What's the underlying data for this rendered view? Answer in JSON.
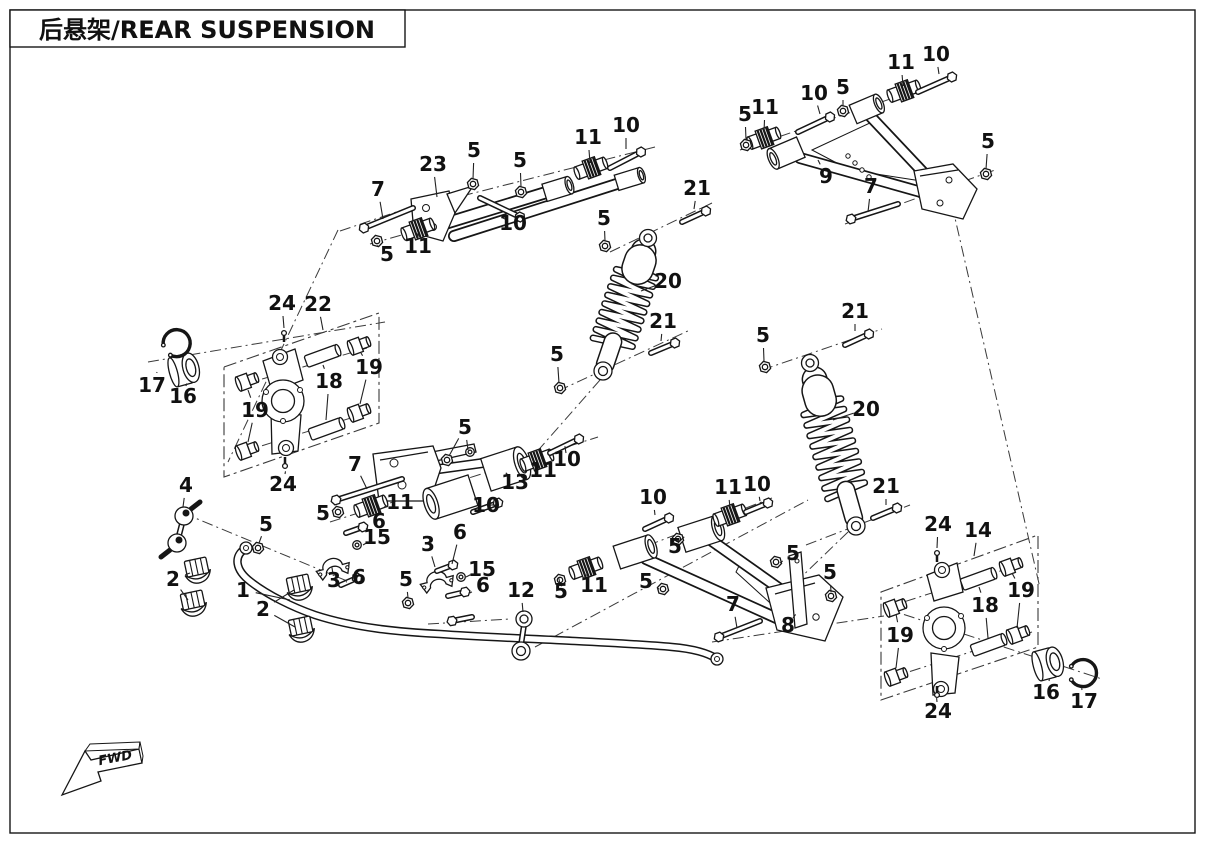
{
  "title": "后悬架/REAR SUSPENSION",
  "fwd_label": "FWD",
  "diagram": {
    "callouts": [
      {
        "t": "7",
        "x": 378,
        "y": 196,
        "l": [
          [
            383,
            219
          ]
        ]
      },
      {
        "t": "23",
        "x": 433,
        "y": 171,
        "l": [
          [
            437,
            197
          ]
        ]
      },
      {
        "t": "5",
        "x": 474,
        "y": 157,
        "l": [
          [
            473,
            179
          ]
        ]
      },
      {
        "t": "5",
        "x": 520,
        "y": 167,
        "l": [
          [
            521,
            187
          ]
        ]
      },
      {
        "t": "11",
        "x": 588,
        "y": 144,
        "l": [
          [
            590,
            163
          ]
        ]
      },
      {
        "t": "10",
        "x": 626,
        "y": 132,
        "l": [
          [
            626,
            149
          ]
        ]
      },
      {
        "t": "5",
        "x": 387,
        "y": 261,
        "l": [
          [
            378,
            246
          ]
        ]
      },
      {
        "t": "11",
        "x": 418,
        "y": 253,
        "l": [
          [
            418,
            237
          ]
        ]
      },
      {
        "t": "10",
        "x": 513,
        "y": 230,
        "l": [
          [
            507,
            220
          ]
        ]
      },
      {
        "t": "11",
        "x": 901,
        "y": 69,
        "l": [
          [
            903,
            86
          ]
        ]
      },
      {
        "t": "10",
        "x": 936,
        "y": 61,
        "l": [
          [
            939,
            74
          ]
        ]
      },
      {
        "t": "10",
        "x": 814,
        "y": 100,
        "l": [
          [
            820,
            114
          ]
        ]
      },
      {
        "t": "5",
        "x": 843,
        "y": 94,
        "l": [
          [
            843,
            106
          ]
        ]
      },
      {
        "t": "5",
        "x": 745,
        "y": 121,
        "l": [
          [
            746,
            140
          ]
        ]
      },
      {
        "t": "11",
        "x": 765,
        "y": 114,
        "l": [
          [
            764,
            132
          ]
        ]
      },
      {
        "t": "9",
        "x": 826,
        "y": 183,
        "l": [
          [
            818,
            160
          ]
        ]
      },
      {
        "t": "7",
        "x": 871,
        "y": 193,
        "l": [
          [
            868,
            212
          ]
        ]
      },
      {
        "t": "5",
        "x": 988,
        "y": 148,
        "l": [
          [
            986,
            169
          ]
        ]
      },
      {
        "t": "21",
        "x": 697,
        "y": 195,
        "l": [
          [
            694,
            209
          ]
        ]
      },
      {
        "t": "5",
        "x": 604,
        "y": 225,
        "l": [
          [
            605,
            241
          ]
        ]
      },
      {
        "t": "20",
        "x": 668,
        "y": 288,
        "l": [
          [
            641,
            291
          ]
        ]
      },
      {
        "t": "21",
        "x": 663,
        "y": 328,
        "l": [
          [
            661,
            341
          ]
        ]
      },
      {
        "t": "5",
        "x": 557,
        "y": 361,
        "l": [
          [
            559,
            383
          ]
        ]
      },
      {
        "t": "21",
        "x": 855,
        "y": 318,
        "l": [
          [
            855,
            331
          ]
        ]
      },
      {
        "t": "5",
        "x": 763,
        "y": 342,
        "l": [
          [
            764,
            361
          ]
        ]
      },
      {
        "t": "20",
        "x": 866,
        "y": 416,
        "l": [
          [
            833,
            420
          ]
        ]
      },
      {
        "t": "21",
        "x": 886,
        "y": 493,
        "l": [
          [
            886,
            505
          ]
        ]
      },
      {
        "t": "24",
        "x": 282,
        "y": 310,
        "l": [
          [
            284,
            328
          ]
        ]
      },
      {
        "t": "22",
        "x": 318,
        "y": 311,
        "l": [
          [
            323,
            330
          ]
        ]
      },
      {
        "t": "17",
        "x": 152,
        "y": 392,
        "l": [
          [
            157,
            372
          ]
        ]
      },
      {
        "t": "16",
        "x": 183,
        "y": 403,
        "l": [
          [
            186,
            386
          ]
        ]
      },
      {
        "t": "19",
        "x": 255,
        "y": 417,
        "l": [
          [
            248,
            390
          ],
          [
            248,
            442
          ]
        ]
      },
      {
        "t": "18",
        "x": 329,
        "y": 388,
        "l": [
          [
            323,
            365
          ],
          [
            326,
            420
          ]
        ]
      },
      {
        "t": "19",
        "x": 369,
        "y": 374,
        "l": [
          [
            361,
            353
          ],
          [
            360,
            404
          ]
        ]
      },
      {
        "t": "24",
        "x": 283,
        "y": 491,
        "l": [
          [
            285,
            474
          ]
        ]
      },
      {
        "t": "4",
        "x": 186,
        "y": 492,
        "l": [
          [
            183,
            507
          ]
        ]
      },
      {
        "t": "5",
        "x": 266,
        "y": 531,
        "l": [
          [
            259,
            543
          ]
        ]
      },
      {
        "t": "2",
        "x": 173,
        "y": 586,
        "l": [
          [
            190,
            573
          ],
          [
            188,
            600
          ]
        ]
      },
      {
        "t": "1",
        "x": 243,
        "y": 597,
        "l": [
          [
            290,
            600
          ]
        ]
      },
      {
        "t": "2",
        "x": 263,
        "y": 616,
        "l": [
          [
            294,
            590
          ],
          [
            295,
            627
          ]
        ]
      },
      {
        "t": "3",
        "x": 334,
        "y": 587,
        "l": [
          [
            333,
            574
          ]
        ]
      },
      {
        "t": "6",
        "x": 359,
        "y": 584,
        "l": [
          [
            346,
            582
          ]
        ]
      },
      {
        "t": "5",
        "x": 406,
        "y": 586,
        "l": [
          [
            408,
            598
          ]
        ]
      },
      {
        "t": "3",
        "x": 428,
        "y": 551,
        "l": [
          [
            435,
            567
          ]
        ]
      },
      {
        "t": "6",
        "x": 379,
        "y": 528,
        "l": [
          [
            366,
            529
          ]
        ]
      },
      {
        "t": "15",
        "x": 377,
        "y": 544,
        "l": [
          [
            363,
            545
          ]
        ]
      },
      {
        "t": "6",
        "x": 460,
        "y": 539,
        "l": [
          [
            452,
            564
          ]
        ]
      },
      {
        "t": "15",
        "x": 482,
        "y": 576,
        "l": [
          [
            466,
            577
          ]
        ]
      },
      {
        "t": "6",
        "x": 483,
        "y": 592,
        "l": [
          [
            470,
            593
          ]
        ]
      },
      {
        "t": "5",
        "x": 323,
        "y": 520,
        "l": [
          [
            336,
            514
          ]
        ]
      },
      {
        "t": "5",
        "x": 465,
        "y": 434,
        "l": [
          [
            449,
            456
          ],
          [
            468,
            450
          ]
        ]
      },
      {
        "t": "7",
        "x": 355,
        "y": 471,
        "l": [
          [
            367,
            489
          ]
        ]
      },
      {
        "t": "11",
        "x": 400,
        "y": 509,
        "l": [
          [
            384,
            507
          ]
        ]
      },
      {
        "t": "13",
        "x": 515,
        "y": 489,
        "l": [
          [
            510,
            477
          ]
        ]
      },
      {
        "t": "11",
        "x": 543,
        "y": 477,
        "l": [
          [
            539,
            468
          ]
        ]
      },
      {
        "t": "10",
        "x": 567,
        "y": 466,
        "l": [
          [
            566,
            453
          ]
        ]
      },
      {
        "t": "10",
        "x": 486,
        "y": 512,
        "l": [
          [
            489,
            505
          ]
        ]
      },
      {
        "t": "12",
        "x": 521,
        "y": 597,
        "l": [
          [
            523,
            612
          ]
        ]
      },
      {
        "t": "5",
        "x": 561,
        "y": 598,
        "l": [
          [
            560,
            585
          ]
        ]
      },
      {
        "t": "11",
        "x": 594,
        "y": 592,
        "l": [
          [
            589,
            578
          ]
        ]
      },
      {
        "t": "5",
        "x": 646,
        "y": 588,
        "l": [
          [
            659,
            589
          ]
        ]
      },
      {
        "t": "10",
        "x": 653,
        "y": 504,
        "l": [
          [
            655,
            515
          ]
        ]
      },
      {
        "t": "11",
        "x": 728,
        "y": 494,
        "l": [
          [
            730,
            508
          ]
        ]
      },
      {
        "t": "10",
        "x": 757,
        "y": 491,
        "l": [
          [
            760,
            501
          ]
        ]
      },
      {
        "t": "5",
        "x": 675,
        "y": 553,
        "l": [
          [
            678,
            543
          ]
        ]
      },
      {
        "t": "7",
        "x": 733,
        "y": 611,
        "l": [
          [
            737,
            628
          ]
        ]
      },
      {
        "t": "8",
        "x": 788,
        "y": 632,
        "l": [
          [
            793,
            618
          ]
        ]
      },
      {
        "t": "5",
        "x": 793,
        "y": 560,
        "l": [
          [
            780,
            563
          ]
        ]
      },
      {
        "t": "5",
        "x": 830,
        "y": 579,
        "l": [
          [
            831,
            592
          ]
        ]
      },
      {
        "t": "24",
        "x": 938,
        "y": 531,
        "l": [
          [
            937,
            548
          ]
        ]
      },
      {
        "t": "14",
        "x": 978,
        "y": 537,
        "l": [
          [
            974,
            556
          ]
        ]
      },
      {
        "t": "19",
        "x": 1021,
        "y": 597,
        "l": [
          [
            1012,
            573
          ],
          [
            1017,
            628
          ]
        ]
      },
      {
        "t": "18",
        "x": 985,
        "y": 612,
        "l": [
          [
            979,
            587
          ],
          [
            988,
            638
          ]
        ]
      },
      {
        "t": "19",
        "x": 900,
        "y": 642,
        "l": [
          [
            896,
            614
          ],
          [
            896,
            668
          ]
        ]
      },
      {
        "t": "16",
        "x": 1046,
        "y": 699,
        "l": [
          [
            1049,
            681
          ]
        ]
      },
      {
        "t": "17",
        "x": 1084,
        "y": 708,
        "l": [
          [
            1082,
            690
          ]
        ]
      },
      {
        "t": "24",
        "x": 938,
        "y": 718,
        "l": [
          [
            937,
            702
          ]
        ]
      }
    ]
  }
}
